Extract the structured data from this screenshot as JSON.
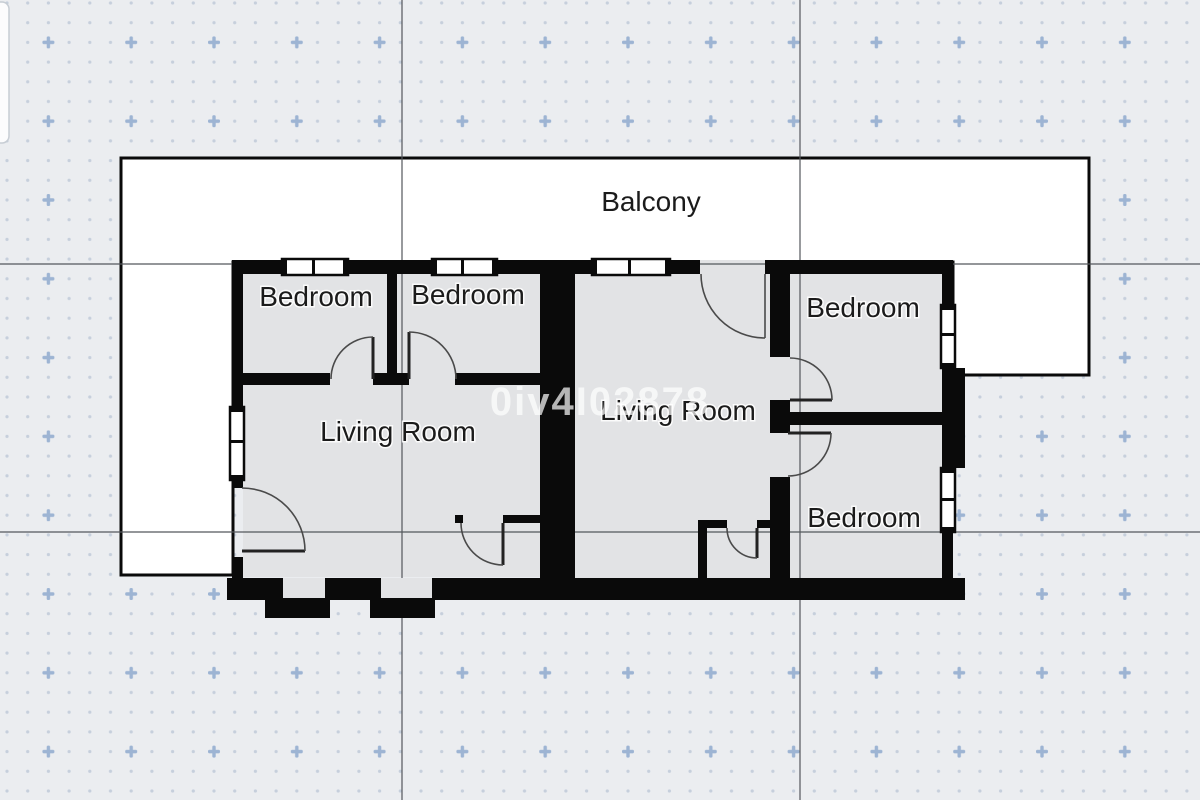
{
  "editor": {
    "watermark": "0iv4I02878",
    "colors": {
      "background": "#ebedf0",
      "dot": "#c6cfdc",
      "plus_marker": "#9db4d3",
      "grid_line": "#53575c",
      "wall": "#0a0a0a",
      "room_fill": "#e2e3e5",
      "balcony_fill": "#ffffff",
      "label_text": "#1b1b1b",
      "watermark_text": "rgba(255,255,255,0.70)"
    }
  },
  "plan": {
    "balcony": {
      "label": "Balcony"
    },
    "rooms": [
      {
        "id": "bedroom-top-left",
        "label": "Bedroom"
      },
      {
        "id": "bedroom-top-middle",
        "label": "Bedroom"
      },
      {
        "id": "living-room-left",
        "label": "Living Room"
      },
      {
        "id": "living-room-center",
        "label": "Living Room"
      },
      {
        "id": "bedroom-top-right",
        "label": "Bedroom"
      },
      {
        "id": "bedroom-bottom-right",
        "label": "Bedroom"
      }
    ]
  }
}
